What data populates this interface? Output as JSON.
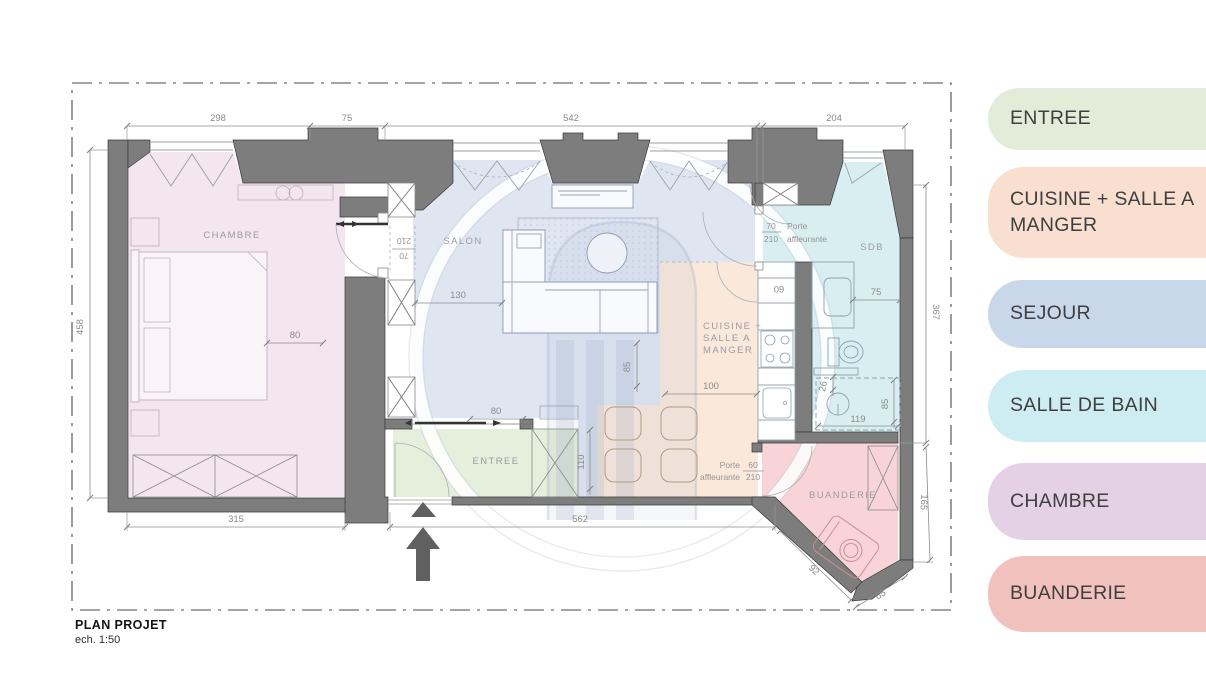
{
  "title": {
    "name": "PLAN PROJET",
    "scale": "ech. 1:50"
  },
  "legend": {
    "items": [
      {
        "label": "ENTREE",
        "color": "#e3ecd9"
      },
      {
        "label": "CUISINE + SALLE A MANGER",
        "color": "#f8dfd0"
      },
      {
        "label": "SEJOUR",
        "color": "#c9d7ea"
      },
      {
        "label": "SALLE DE BAIN",
        "color": "#cdedf2"
      },
      {
        "label": "CHAMBRE",
        "color": "#e5d1e6"
      },
      {
        "label": "BUANDERIE",
        "color": "#f1c1bd"
      }
    ]
  },
  "rooms": {
    "chambre": "CHAMBRE",
    "salon": "SALON",
    "sdb": "SDB",
    "entree": "ENTREE",
    "buanderie": "BUANDERIE",
    "cuisine": [
      "CUISINE +",
      "SALLE A",
      "MANGER"
    ]
  },
  "dims": {
    "top": [
      "298",
      "75",
      "542",
      "204"
    ],
    "left": "458",
    "bottom": [
      "315",
      "562"
    ],
    "right": [
      "367",
      "165"
    ],
    "diag": [
      "92",
      "65"
    ],
    "chambre_closet": "80",
    "salon_sofa": "130",
    "entree_door": "80",
    "entree_depth": "110",
    "dining_gap": "85",
    "dining_width": "100",
    "kitchen_niche": "60",
    "sdb_width": "75",
    "sdb_niche": "26",
    "shower_depth": "85",
    "shower_width": "119"
  },
  "doors": {
    "chambre": {
      "width": "70",
      "height": "210"
    },
    "sdb": {
      "width": "70",
      "height": "210",
      "label1": "Porte",
      "label2": "affleurante"
    },
    "buanderie": {
      "width": "60",
      "height": "210",
      "label1": "Porte",
      "label2": "affleurante"
    }
  },
  "colors": {
    "room_chambre": "#f3e6ee",
    "room_salon": "#dfe6f2",
    "room_cuisine": "#fae8da",
    "room_sdb": "#d9eef1",
    "room_entree": "#e6eedc",
    "room_buanderie": "#f8d4d8",
    "wall": "#7d7d7d",
    "arrow": "#606060"
  }
}
